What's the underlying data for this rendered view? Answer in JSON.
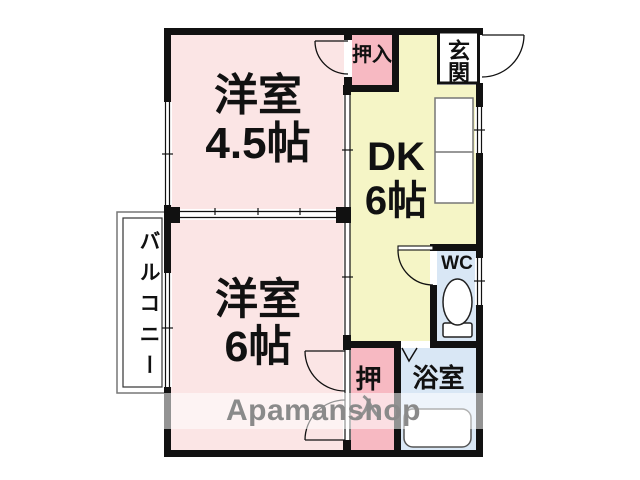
{
  "colors": {
    "room_pink": "#fbe5e5",
    "closet_pink": "#f7b9c2",
    "dk_yellow": "#f5f5c6",
    "wet_blue": "#d9e7f5",
    "wall": "#111111",
    "watermark": "#8a8a8a"
  },
  "rooms": {
    "western_45": {
      "name": "洋室",
      "size": "4.5帖"
    },
    "western_6": {
      "name": "洋室",
      "size": "6帖"
    },
    "dk": {
      "name": "DK",
      "size": "6帖"
    },
    "closet_top": {
      "label": "押入"
    },
    "closet_bottom": {
      "label": "押入"
    },
    "entrance": {
      "label": "玄関"
    },
    "toilet": {
      "label": "WC"
    },
    "bathroom": {
      "label": "浴室"
    },
    "balcony": {
      "label": "バルコニー"
    }
  },
  "watermark": {
    "text": "Apamanshop"
  }
}
